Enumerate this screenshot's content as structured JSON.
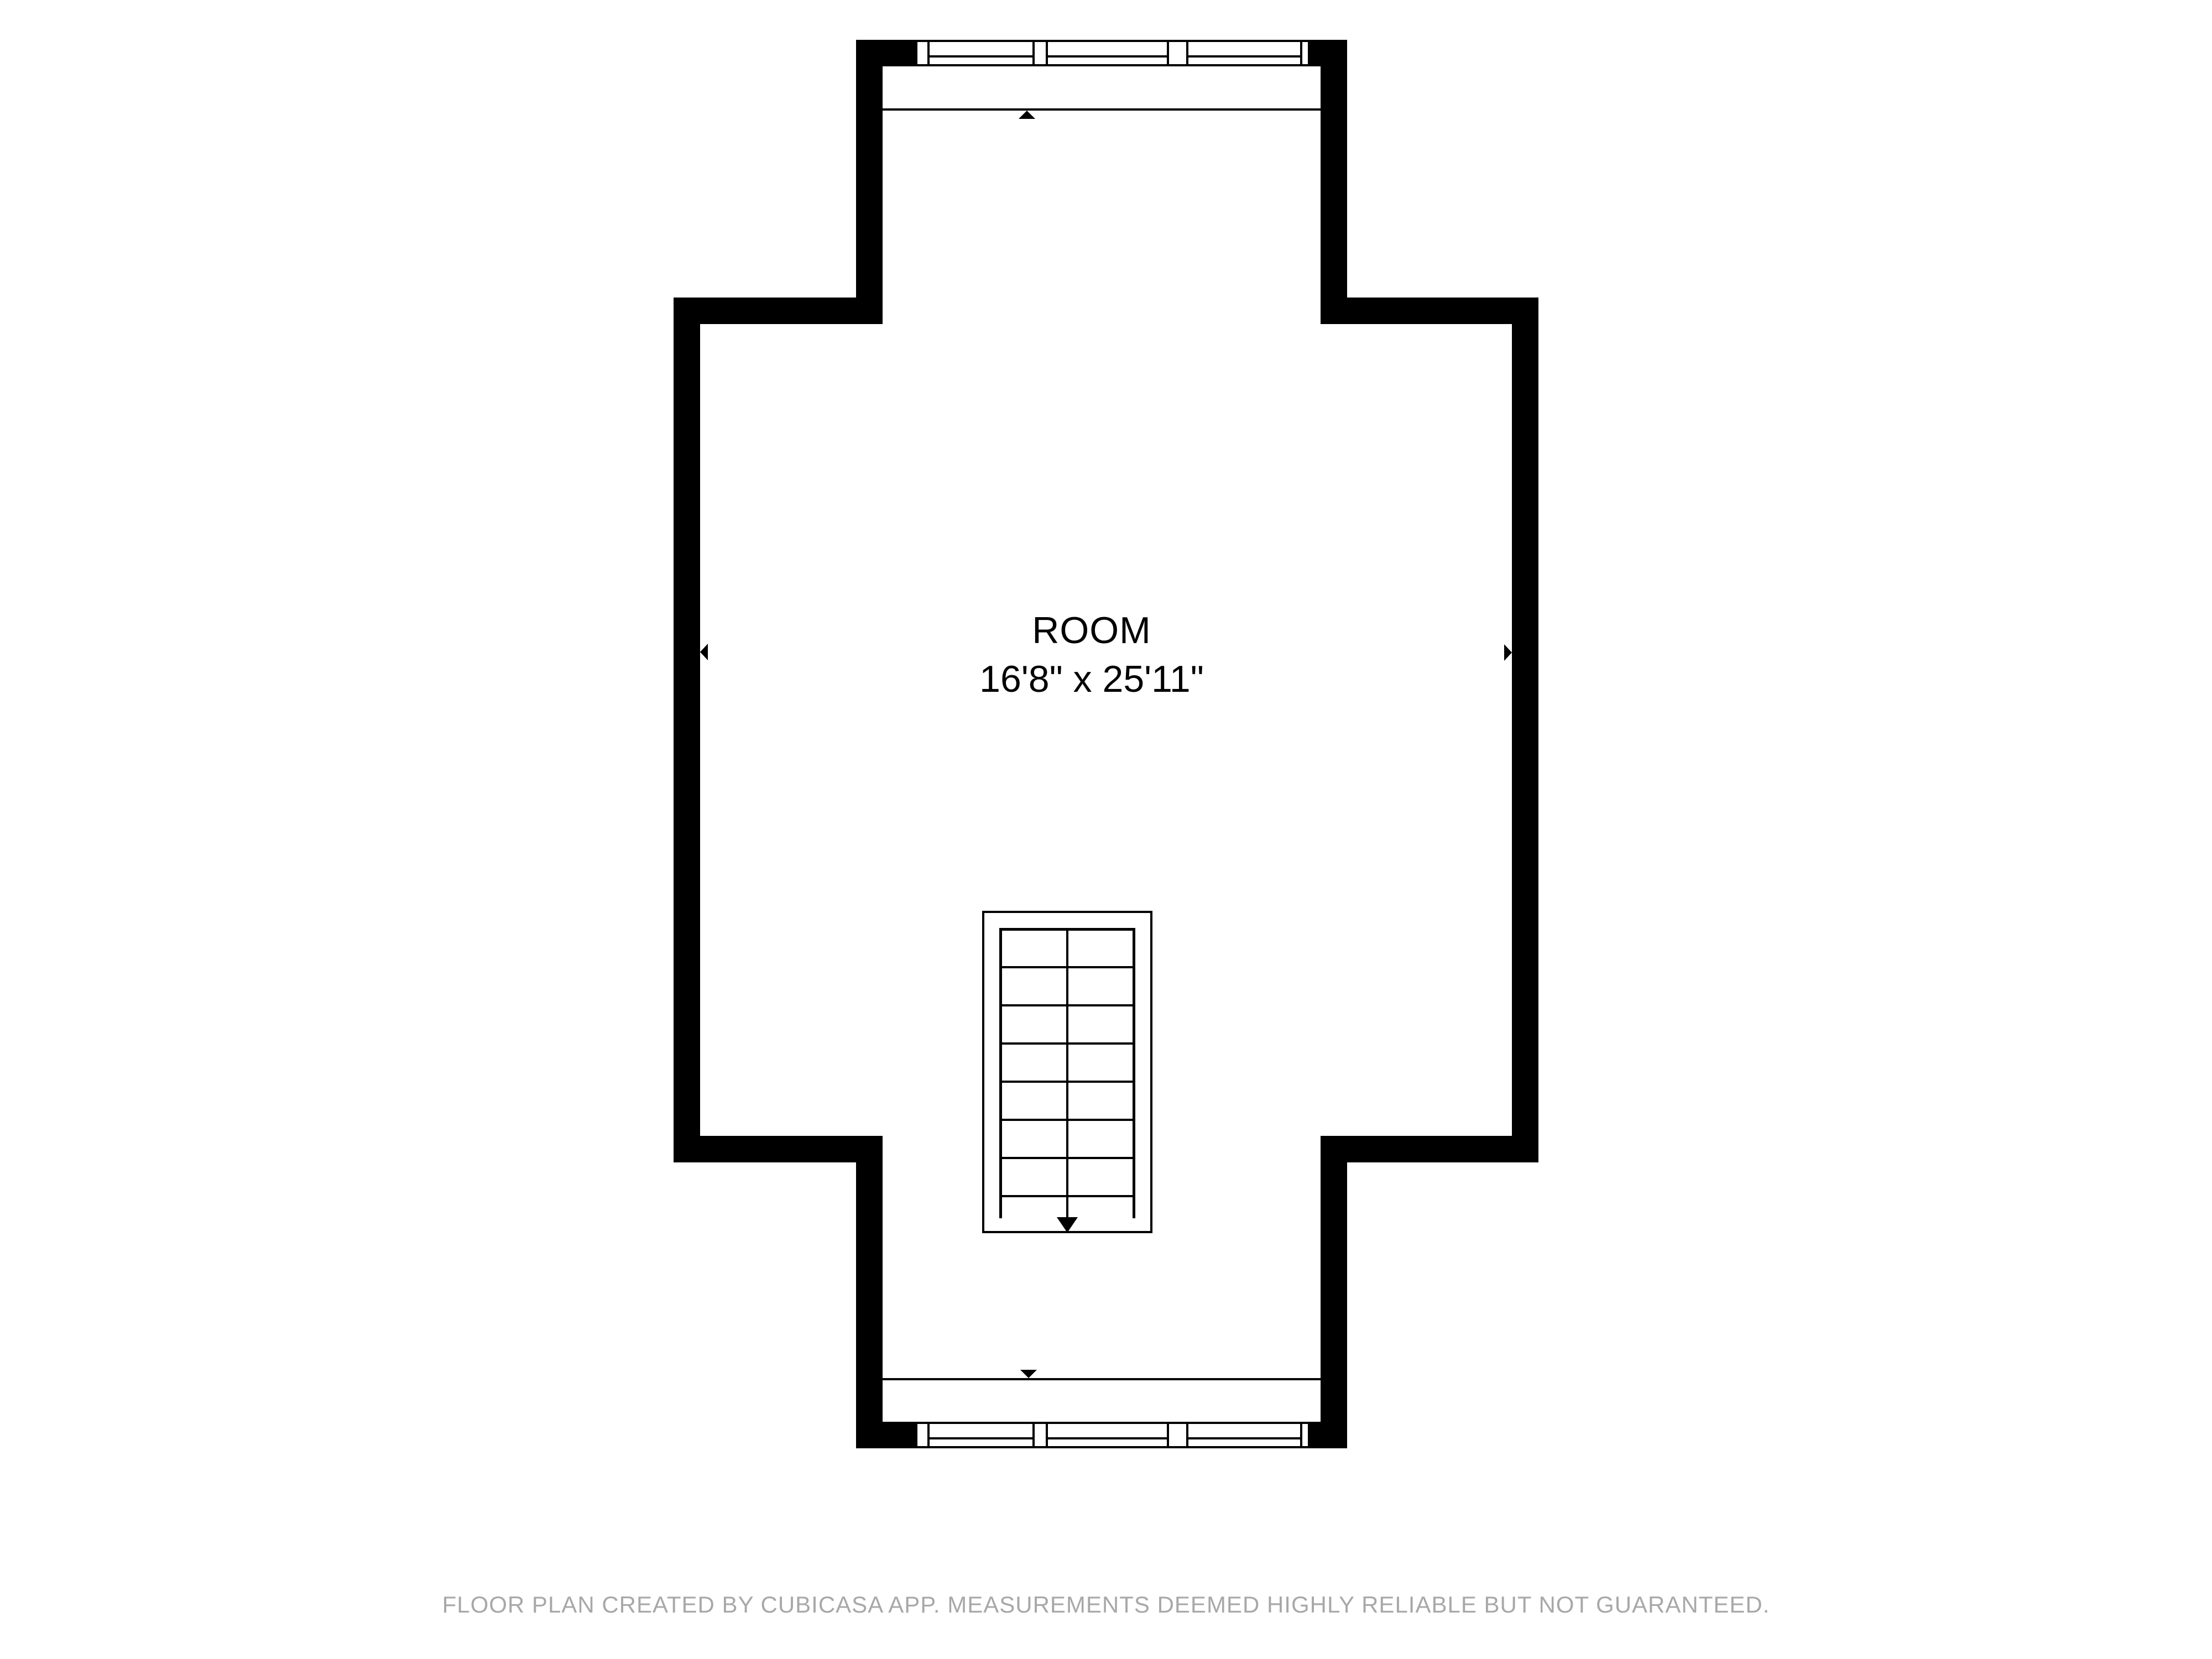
{
  "room": {
    "name": "ROOM",
    "dimensions": "16'8\" x 25'11\""
  },
  "footer": {
    "text": "FLOOR PLAN CREATED BY CUBICASA APP. MEASUREMENTS DEEMED HIGHLY RELIABLE BUT NOT GUARANTEED."
  },
  "colors": {
    "wall": "#000000",
    "background": "#ffffff",
    "footer_text": "#a8a8a8",
    "label_text": "#000000"
  },
  "icons": {
    "wall_markers": [
      "arrow-up-icon",
      "arrow-down-icon",
      "arrow-left-icon",
      "arrow-right-icon"
    ],
    "stair_direction": "arrow-down-icon"
  }
}
